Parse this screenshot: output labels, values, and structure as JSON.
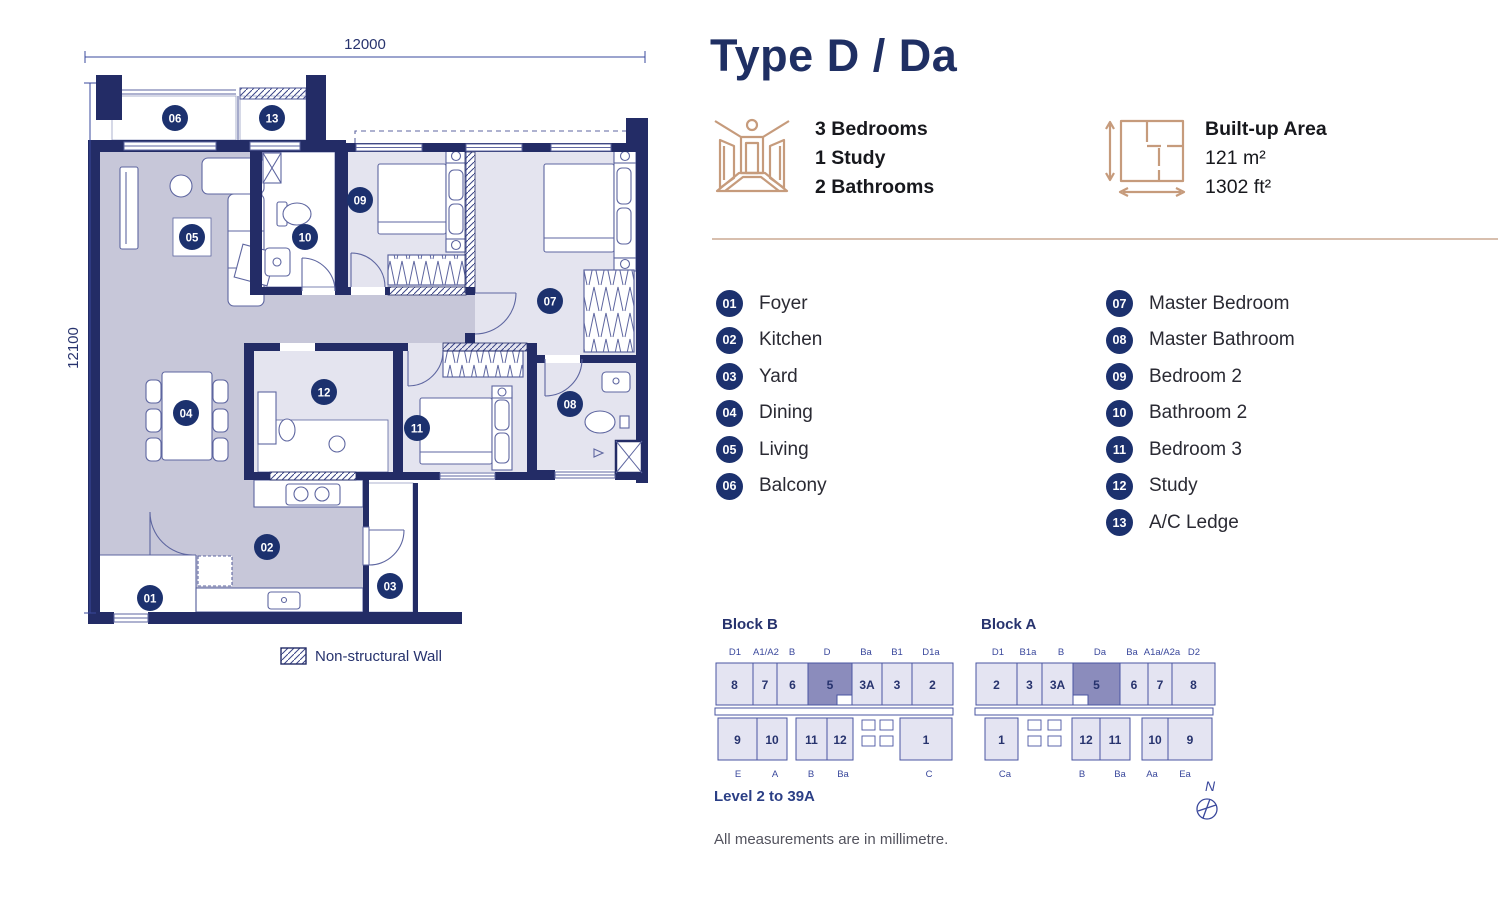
{
  "title": "Type D / Da",
  "features": {
    "rooms": {
      "icon": "room-perspective-icon",
      "lines": [
        "3 Bedrooms",
        "1 Study",
        "2 Bathrooms"
      ]
    },
    "area": {
      "icon": "area-dimensions-icon",
      "label": "Built-up Area",
      "lines": [
        "121 m²",
        "1302 ft²"
      ]
    }
  },
  "legend": {
    "col1": [
      {
        "num": "01",
        "label": "Foyer"
      },
      {
        "num": "02",
        "label": "Kitchen"
      },
      {
        "num": "03",
        "label": "Yard"
      },
      {
        "num": "04",
        "label": "Dining"
      },
      {
        "num": "05",
        "label": "Living"
      },
      {
        "num": "06",
        "label": "Balcony"
      }
    ],
    "col2": [
      {
        "num": "07",
        "label": "Master Bedroom"
      },
      {
        "num": "08",
        "label": "Master Bathroom"
      },
      {
        "num": "09",
        "label": "Bedroom 2"
      },
      {
        "num": "10",
        "label": "Bathroom 2"
      },
      {
        "num": "11",
        "label": "Bedroom 3"
      },
      {
        "num": "12",
        "label": "Study"
      },
      {
        "num": "13",
        "label": "A/C Ledge"
      }
    ]
  },
  "floorplan": {
    "dim_top": "12000",
    "dim_left": "12100",
    "wall_legend": "Non-structural Wall",
    "badges": [
      {
        "num": "01",
        "x": 150,
        "y": 598
      },
      {
        "num": "02",
        "x": 267,
        "y": 547
      },
      {
        "num": "03",
        "x": 390,
        "y": 586
      },
      {
        "num": "04",
        "x": 186,
        "y": 413
      },
      {
        "num": "05",
        "x": 192,
        "y": 237
      },
      {
        "num": "06",
        "x": 175,
        "y": 118
      },
      {
        "num": "07",
        "x": 550,
        "y": 301
      },
      {
        "num": "08",
        "x": 570,
        "y": 404
      },
      {
        "num": "09",
        "x": 360,
        "y": 200
      },
      {
        "num": "10",
        "x": 305,
        "y": 237
      },
      {
        "num": "11",
        "x": 417,
        "y": 428
      },
      {
        "num": "12",
        "x": 324,
        "y": 392
      },
      {
        "num": "13",
        "x": 272,
        "y": 118
      }
    ]
  },
  "blocks": [
    {
      "name": "Block B",
      "top_labels": [
        {
          "t": "D1",
          "x": 25
        },
        {
          "t": "A1/A2",
          "x": 56
        },
        {
          "t": "B",
          "x": 82
        },
        {
          "t": "D",
          "x": 117
        },
        {
          "t": "Ba",
          "x": 156
        },
        {
          "t": "B1",
          "x": 187
        },
        {
          "t": "D1a",
          "x": 221
        }
      ],
      "top_units": [
        {
          "label": "8",
          "x": 6,
          "w": 37
        },
        {
          "label": "7",
          "x": 43,
          "w": 24
        },
        {
          "label": "6",
          "x": 67,
          "w": 31
        },
        {
          "label": "5",
          "x": 98,
          "w": 44,
          "highlight": true,
          "notch": "br"
        },
        {
          "label": "3A",
          "x": 142,
          "w": 30
        },
        {
          "label": "3",
          "x": 172,
          "w": 30
        },
        {
          "label": "2",
          "x": 202,
          "w": 41
        }
      ],
      "corridor": {
        "x": 5,
        "w": 238
      },
      "bottom_units": [
        {
          "label": "9",
          "x": 8,
          "w": 39
        },
        {
          "label": "10",
          "x": 47,
          "w": 30
        },
        {
          "label": "11",
          "x": 86,
          "w": 31
        },
        {
          "label": "12",
          "x": 117,
          "w": 26
        },
        {
          "label": "1",
          "x": 190,
          "w": 52
        }
      ],
      "cores": [
        {
          "x": 152,
          "y": 82,
          "w": 13,
          "h": 10
        },
        {
          "x": 170,
          "y": 82,
          "w": 13,
          "h": 10
        },
        {
          "x": 152,
          "y": 98,
          "w": 13,
          "h": 10
        },
        {
          "x": 170,
          "y": 98,
          "w": 13,
          "h": 10
        }
      ],
      "bottom_labels": [
        {
          "t": "E",
          "x": 28
        },
        {
          "t": "A",
          "x": 65
        },
        {
          "t": "B",
          "x": 101
        },
        {
          "t": "Ba",
          "x": 133
        },
        {
          "t": "C",
          "x": 219
        }
      ]
    },
    {
      "name": "Block A",
      "top_labels": [
        {
          "t": "D1",
          "x": 30
        },
        {
          "t": "B1a",
          "x": 60
        },
        {
          "t": "B",
          "x": 93
        },
        {
          "t": "Da",
          "x": 132
        },
        {
          "t": "Ba",
          "x": 164
        },
        {
          "t": "A1a/A2a",
          "x": 194
        },
        {
          "t": "D2",
          "x": 226
        }
      ],
      "top_units": [
        {
          "label": "2",
          "x": 8,
          "w": 41
        },
        {
          "label": "3",
          "x": 49,
          "w": 25
        },
        {
          "label": "3A",
          "x": 74,
          "w": 31
        },
        {
          "label": "5",
          "x": 105,
          "w": 47,
          "highlight": true,
          "notch": "bl"
        },
        {
          "label": "6",
          "x": 152,
          "w": 28
        },
        {
          "label": "7",
          "x": 180,
          "w": 24
        },
        {
          "label": "8",
          "x": 204,
          "w": 43
        }
      ],
      "corridor": {
        "x": 7,
        "w": 238
      },
      "bottom_units": [
        {
          "label": "1",
          "x": 17,
          "w": 33
        },
        {
          "label": "12",
          "x": 104,
          "w": 28
        },
        {
          "label": "11",
          "x": 132,
          "w": 30
        },
        {
          "label": "10",
          "x": 174,
          "w": 26
        },
        {
          "label": "9",
          "x": 200,
          "w": 44
        }
      ],
      "cores": [
        {
          "x": 60,
          "y": 82,
          "w": 13,
          "h": 10
        },
        {
          "x": 80,
          "y": 82,
          "w": 13,
          "h": 10
        },
        {
          "x": 60,
          "y": 98,
          "w": 13,
          "h": 10
        },
        {
          "x": 80,
          "y": 98,
          "w": 13,
          "h": 10
        }
      ],
      "bottom_labels": [
        {
          "t": "Ca",
          "x": 37
        },
        {
          "t": "B",
          "x": 114
        },
        {
          "t": "Ba",
          "x": 152
        },
        {
          "t": "Aa",
          "x": 184
        },
        {
          "t": "Ea",
          "x": 217
        }
      ]
    }
  ],
  "level_note": "Level 2 to 39A",
  "footnote": "All measurements are in millimetre.",
  "compass_label": "N",
  "colors": {
    "wall_navy": "#232c66",
    "badge_navy": "#1c316e",
    "title_navy": "#1f2f63",
    "bronze": "#c69b7c",
    "divider_tan": "#d8bfae",
    "room_dark": "#c7c7d9",
    "room_light": "#e4e4ef",
    "plan_line": "#5e66a0",
    "block_fill": "#e4e4f2",
    "block_highlight": "#8b8cbc",
    "block_stroke": "#4a55a2",
    "label_blue": "#3a489c",
    "text_dark": "#17181d",
    "text_gray": "#53535e"
  }
}
